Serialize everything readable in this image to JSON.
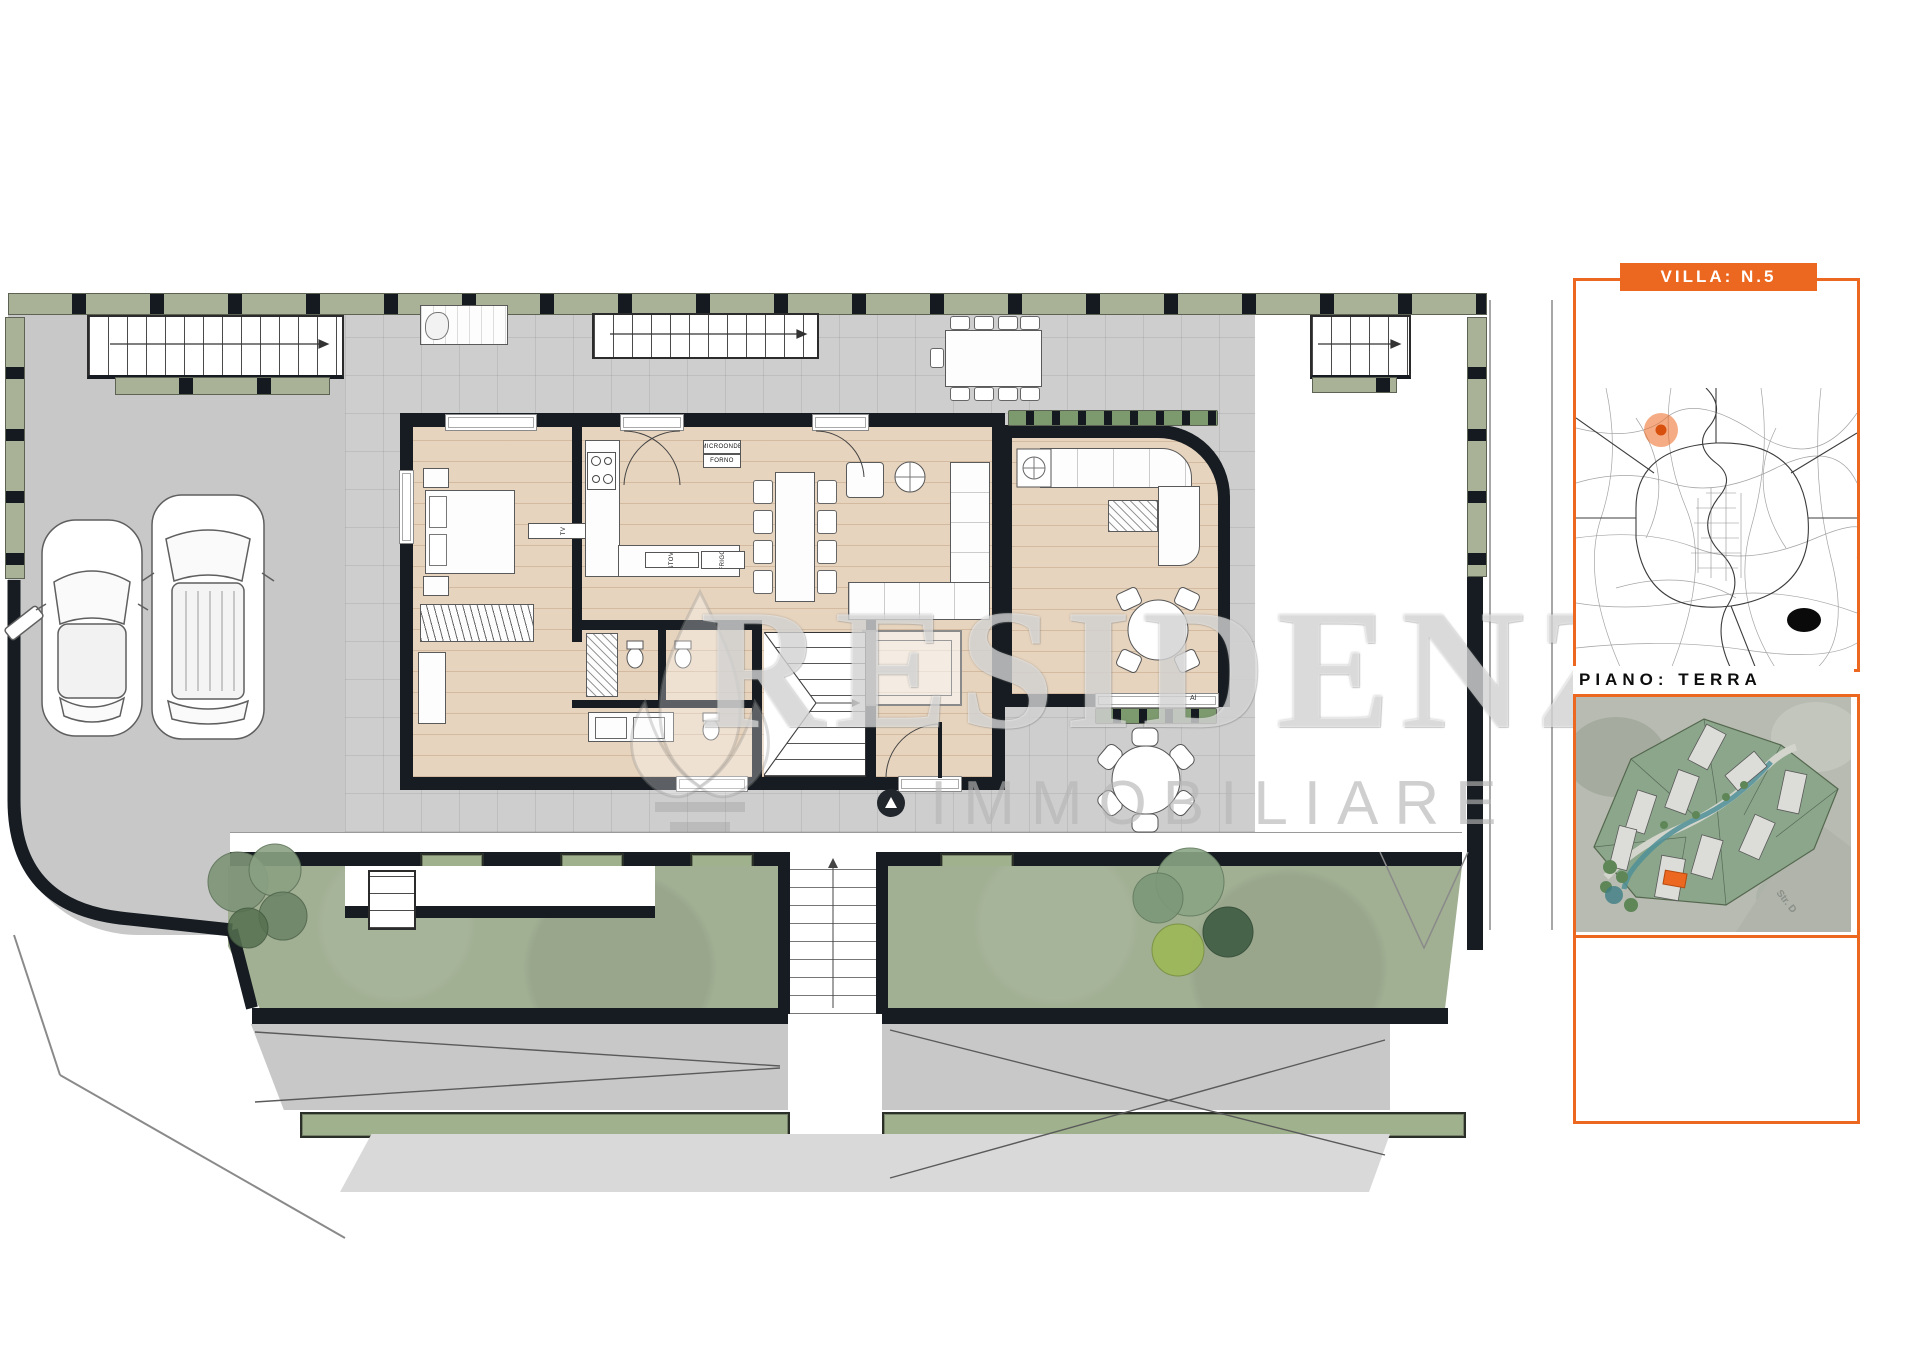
{
  "panel": {
    "banner": {
      "label": "VILLA: N.5"
    },
    "floor_label": "PIANO: TERRA",
    "site_map": {
      "street_label": "Str. D"
    }
  },
  "watermark": {
    "name": "RESIDENZE",
    "subtitle": "IMMOBILIARE"
  },
  "plan": {
    "labels": {
      "microwave": "MICROONDE",
      "oven": "FORNO",
      "fridge": "FRIGO",
      "dishwasher": "LAVASTOVIGLIE",
      "tv": "TV",
      "window_sill": "Al"
    }
  },
  "colors": {
    "accent": "#ec671f",
    "wall": "#161c21",
    "terrace": "#cecece",
    "driveway": "#c8c8c8",
    "lawn": "#a1af93",
    "hedge": "#a9b297",
    "wood": "#e7d4be"
  }
}
